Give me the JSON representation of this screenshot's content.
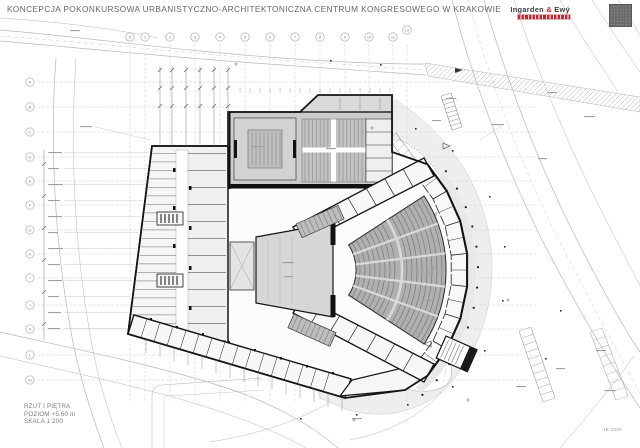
{
  "header": {
    "title": "KONCEPCJA POKONKURSOWA URBANISTYCZNO-ARCHITEKTONICZNA CENTRUM KONGRESOWEGO W KRAKOWIE",
    "logo": {
      "first": "Ingarden ",
      "amp": "&",
      "last": " Ewý"
    }
  },
  "titleblock": {
    "drawing": "RZUT I PIĘTRA",
    "level": "POZIOM +5.60 m",
    "scale": "SKALA 1:200"
  },
  "stamp": {
    "code": "IE 2006"
  },
  "grid": {
    "columns": [
      "0",
      "1",
      "2",
      "3",
      "4",
      "5",
      "6",
      "7",
      "8",
      "9",
      "10",
      "11",
      "12"
    ],
    "rows": [
      "A",
      "B",
      "C",
      "D",
      "E",
      "F",
      "G",
      "H",
      "I",
      "J",
      "K",
      "L",
      "M"
    ]
  },
  "colors": {
    "wall": "#1c1c1c",
    "hall_fill": "#cbcbcb",
    "seat_fill": "#b0b0b0",
    "plaza": "#eeeeee",
    "line_gray": "#b5b5b5",
    "accent_red": "#c6232d"
  }
}
